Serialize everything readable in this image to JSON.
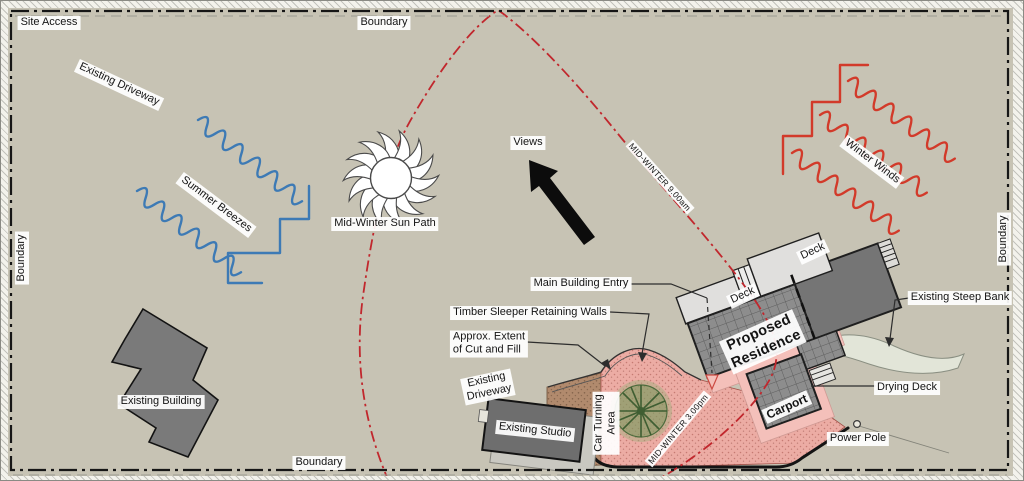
{
  "plan": {
    "title": "Site analysis plan",
    "labels": {
      "site_access": "Site Access",
      "boundary": "Boundary",
      "existing_driveway_nw": "Existing Driveway",
      "summer_breezes": "Summer Breezes",
      "mid_winter_sun_path": "Mid-Winter Sun Path",
      "views": "Views",
      "mid_winter_9am": "MID-WINTER 9.00am",
      "winter_winds": "Winter Winds",
      "existing_steep_bank": "Existing Steep Bank",
      "main_building_entry": "Main Building Entry",
      "timber_sleeper_retaining_walls": "Timber Sleeper Retaining Walls",
      "approx_extent_line1": "Approx. Extent",
      "approx_extent_line2": "of Cut and Fill",
      "existing_driveway_s_line1": "Existing",
      "existing_driveway_s_line2": "Driveway",
      "existing_studio": "Existing Studio",
      "car_turning_line1": "Car Turning",
      "car_turning_line2": "Area",
      "mid_winter_3pm": "MID-WINTER 3.00pm",
      "proposed_residence_line1": "Proposed",
      "proposed_residence_line2": "Residence",
      "deck": "Deck",
      "carport": "Carport",
      "existing_building": "Existing Building",
      "drying_deck": "Drying Deck",
      "power_pole": "Power Pole"
    },
    "colors": {
      "sun_path_red": "#c1272d",
      "winter_wind_red": "#d23a2a",
      "summer_breeze_blue": "#3d7ab5",
      "boundary_black": "#1a1a1a",
      "proposed_hatch_gray": "#8d8d8d",
      "roof_dark_gray": "#757575",
      "deck_light_gray": "#dedddb",
      "paving_pink": "#ecaca4",
      "paving_brown": "#b18a6d",
      "existing_building_gray": "#7a7a7a"
    }
  }
}
